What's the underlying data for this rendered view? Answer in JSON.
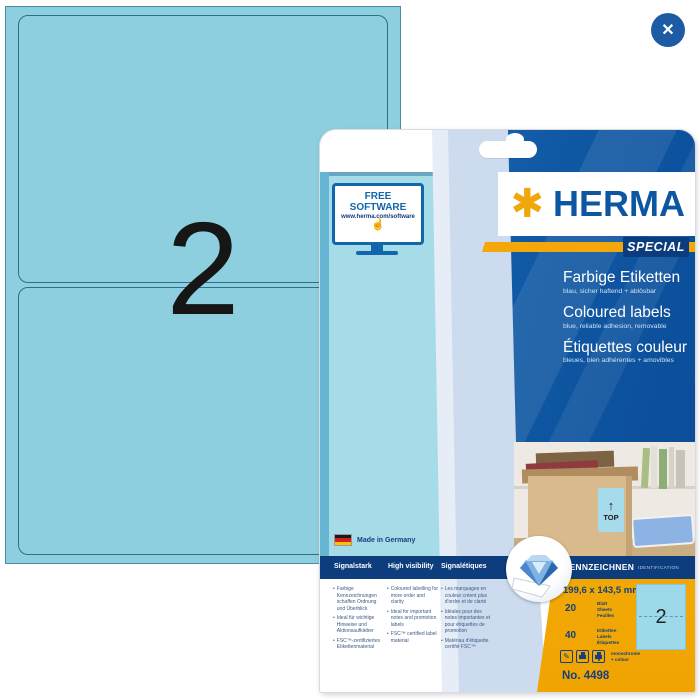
{
  "icons": {
    "close": "✕",
    "star": "✱",
    "hand": "☝",
    "arrow_up": "↑",
    "pencil": "✎",
    "bullet": "•"
  },
  "sheet": {
    "labels_per_sheet": "2"
  },
  "package": {
    "free_software": {
      "title": "FREE SOFTWARE",
      "url": "www.herma.com/software"
    },
    "brand": {
      "name": "HERMA",
      "badge": "SPECIAL"
    },
    "product_titles": [
      {
        "title": "Farbige Etiketten",
        "subtitle": "blau, sicher haftend + ablösbar"
      },
      {
        "title": "Coloured labels",
        "subtitle": "blue, reliable adhesion, removable"
      },
      {
        "title": "Étiquettes couleur",
        "subtitle": "bleues, bien adhérentes + amovibles"
      }
    ],
    "made_in": "Made in Germany",
    "photo": {
      "box_label": "TOP"
    },
    "info_bar": {
      "col_de": "Signalstark",
      "col_en": "High visibility",
      "col_fr": "Signalétiques",
      "id_title": "KENNZEICHNEN",
      "id_sub": "IDENTIFICATION"
    },
    "info_columns": [
      {
        "bullets": [
          "Farbige Kennzeichnungen schaffen Ordnung und Überblick",
          "Ideal für wichtige Hinweise und Aktionsaufkleber",
          "FSC™-zertifiziertes Etikettenmaterial"
        ]
      },
      {
        "bullets": [
          "Coloured labelling for more order and clarity",
          "Ideal for important notes and promotion labels",
          "FSC™ certified label material"
        ]
      },
      {
        "bullets": [
          "Les marquages en couleur créent plus d'ordre et de clarté",
          "Idéales pour des notes importantes et pour étiquettes de promotion",
          "Matériau d'étiquette certifié FSC™"
        ]
      }
    ],
    "specs": {
      "dimensions": "199,6 x 143,5 mm",
      "sheets": {
        "count": "20",
        "units": [
          "Blatt",
          "Sheets",
          "Feuilles"
        ]
      },
      "labels": {
        "count": "40",
        "units": [
          "Etiketten",
          "Labels",
          "Étiquettes"
        ]
      },
      "print_note": [
        "monochrome",
        "+ colour"
      ],
      "order_no": "No. 4498",
      "mini_label_count": "2"
    },
    "colors": {
      "brand_blue": "#0d57a2",
      "panel_blue": "#0d4f9c",
      "accent_orange": "#f3a70a",
      "sidebar_yellow": "#f5ad06",
      "label_blue": "#9ed9ea",
      "navy_bar": "#0d3d7d",
      "sheet_blue": "#8ecfdf"
    }
  }
}
